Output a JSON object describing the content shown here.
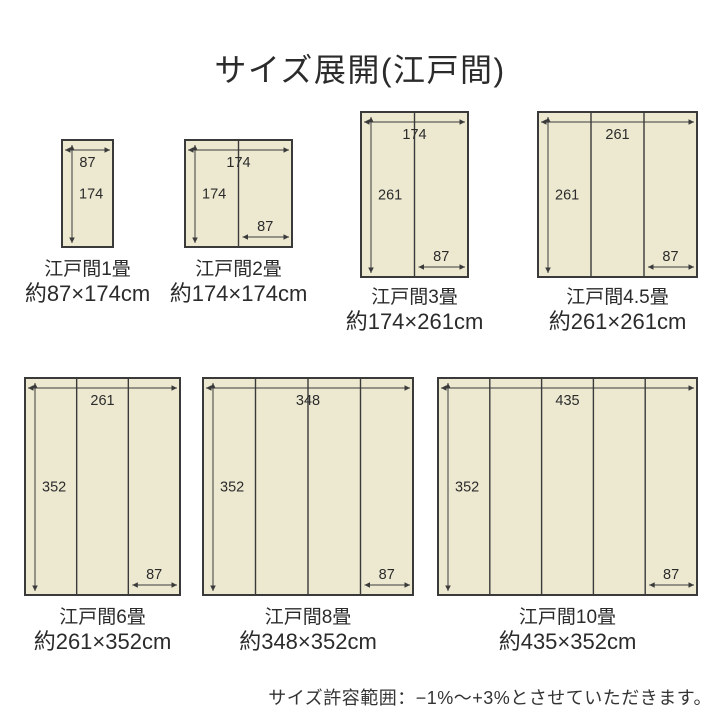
{
  "title": "サイズ展開(江戸間)",
  "note": "サイズ許容範囲：−1%〜+3%とさせていただきます。",
  "unit": "cm",
  "colors": {
    "tatami_fill": "#EDE9D1",
    "outline": "#3a3a3a",
    "dimension_text": "#2b2b2b"
  },
  "diagrams": [
    {
      "name": "江戸間1畳",
      "size_text": "約87×174cm",
      "width_cm": 87,
      "height_cm": 174,
      "panels": 1,
      "width_label": "87",
      "height_label": "174",
      "panel_width_label": ""
    },
    {
      "name": "江戸間2畳",
      "size_text": "約174×174cm",
      "width_cm": 174,
      "height_cm": 174,
      "panels": 2,
      "width_label": "174",
      "height_label": "174",
      "panel_width_label": "87"
    },
    {
      "name": "江戸間3畳",
      "size_text": "約174×261cm",
      "width_cm": 174,
      "height_cm": 261,
      "panels": 2,
      "width_label": "174",
      "height_label": "261",
      "panel_width_label": "87"
    },
    {
      "name": "江戸間4.5畳",
      "size_text": "約261×261cm",
      "width_cm": 261,
      "height_cm": 261,
      "panels": 3,
      "width_label": "261",
      "height_label": "261",
      "panel_width_label": "87"
    },
    {
      "name": "江戸間6畳",
      "size_text": "約261×352cm",
      "width_cm": 261,
      "height_cm": 352,
      "panels": 3,
      "width_label": "261",
      "height_label": "352",
      "panel_width_label": "87"
    },
    {
      "name": "江戸間8畳",
      "size_text": "約348×352cm",
      "width_cm": 348,
      "height_cm": 352,
      "panels": 4,
      "width_label": "348",
      "height_label": "352",
      "panel_width_label": "87"
    },
    {
      "name": "江戸間10畳",
      "size_text": "約435×352cm",
      "width_cm": 435,
      "height_cm": 352,
      "panels": 5,
      "width_label": "435",
      "height_label": "352",
      "panel_width_label": "87"
    }
  ]
}
